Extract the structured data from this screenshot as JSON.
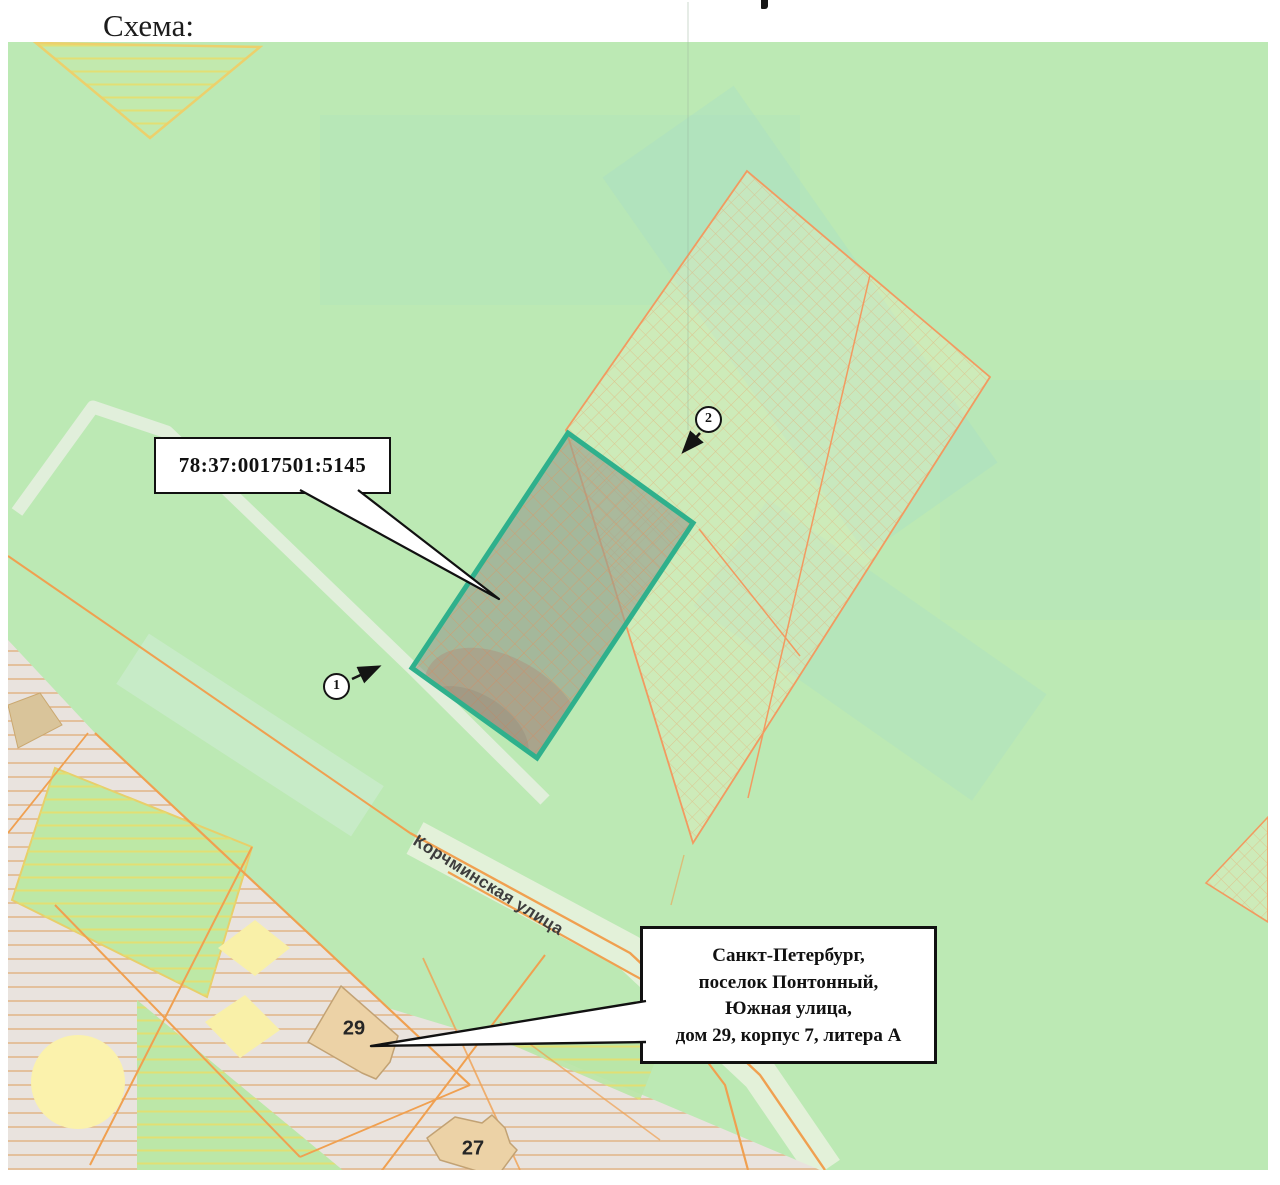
{
  "title": "Схема:",
  "map": {
    "cadastral_callout": {
      "number": "78:37:0017501:5145"
    },
    "address_callout": {
      "lines": [
        "Санкт-Петербург,",
        "поселок Понтонный,",
        "Южная улица,",
        "дом 29, корпус 7, литера А"
      ]
    },
    "street_label": "Корчминская улица",
    "buildings": {
      "b29": "29",
      "b27": "27"
    },
    "markers": {
      "m1": "1",
      "m2": "2"
    },
    "colors": {
      "map_green": "#bce9b4",
      "target_parcel_border_teal": "#2fb08c",
      "parcel_hatch_orange": "#ee8c52",
      "road_orange": "#f0a050",
      "building_fill": "#ecd2a6",
      "hatch_yellow": "#e6de6e",
      "gray_parcel": "#e9e3de"
    }
  }
}
